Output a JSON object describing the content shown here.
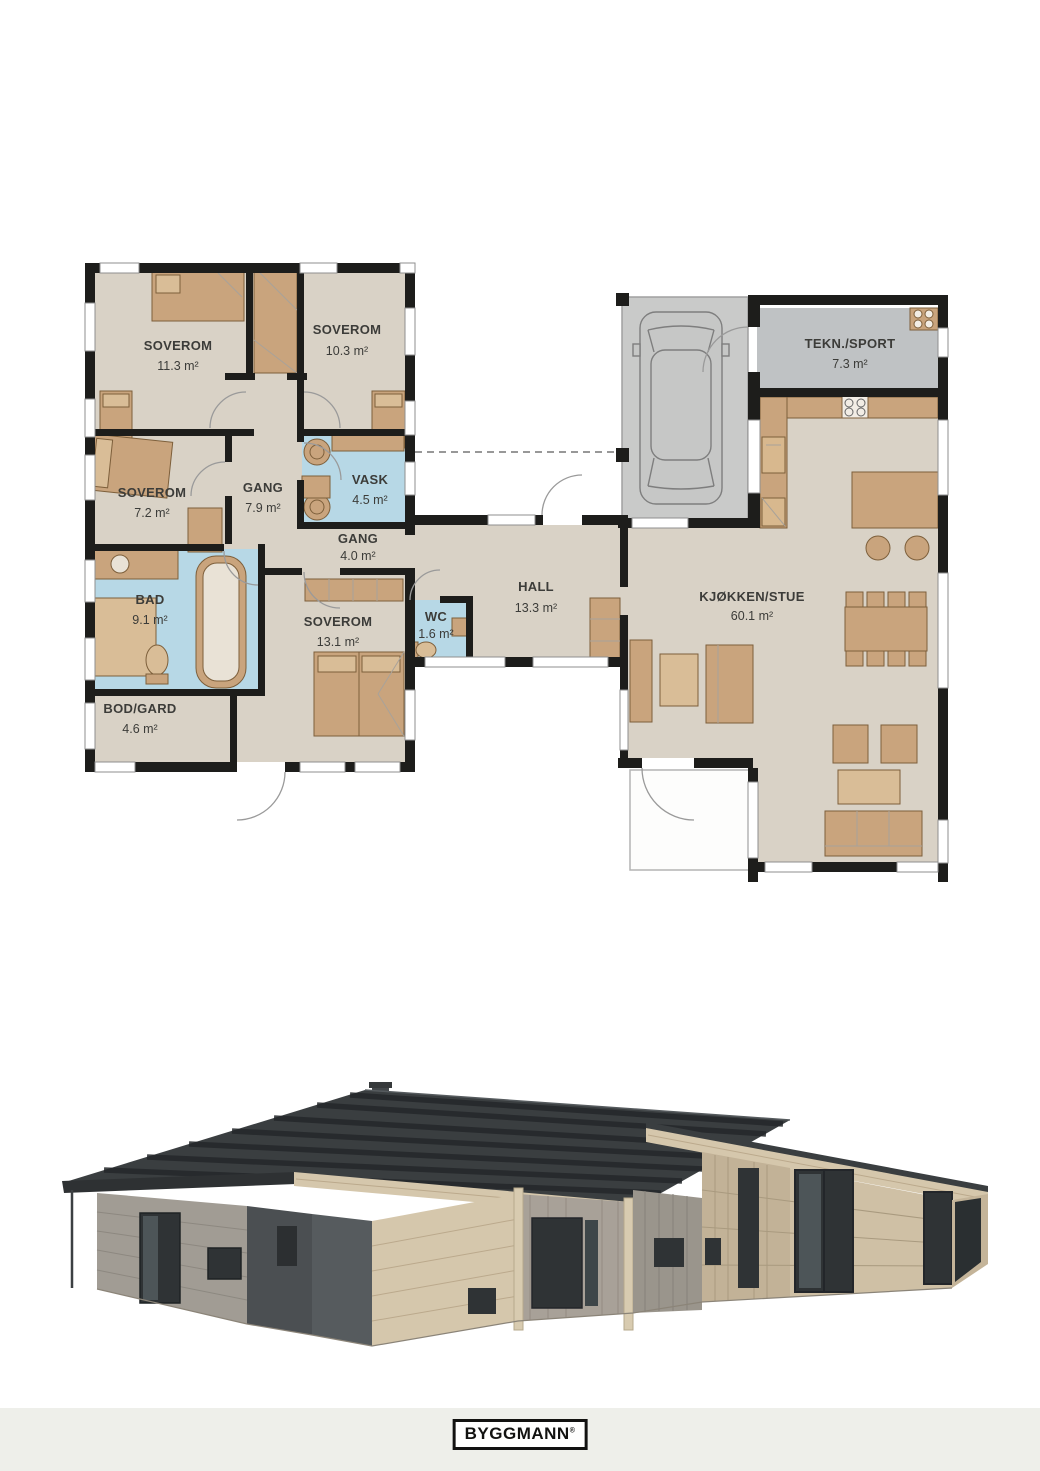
{
  "document": {
    "kind": "house floor plan brochure page"
  },
  "plan": {
    "rooms": [
      {
        "id": "soverom-11-3",
        "name": "SOVEROM",
        "area": "11.3 m²"
      },
      {
        "id": "soverom-10-3",
        "name": "SOVEROM",
        "area": "10.3 m²"
      },
      {
        "id": "soverom-7-2",
        "name": "SOVEROM",
        "area": "7.2 m²"
      },
      {
        "id": "gang-7-9",
        "name": "GANG",
        "area": "7.9 m²"
      },
      {
        "id": "vask",
        "name": "VASK",
        "area": "4.5 m²"
      },
      {
        "id": "gang-4-0",
        "name": "GANG",
        "area": "4.0 m²"
      },
      {
        "id": "bad",
        "name": "BAD",
        "area": "9.1 m²"
      },
      {
        "id": "bod-gard",
        "name": "BOD/GARD",
        "area": "4.6 m²"
      },
      {
        "id": "soverom-13-1",
        "name": "SOVEROM",
        "area": "13.1 m²"
      },
      {
        "id": "wc",
        "name": "WC",
        "area": "1.6 m²"
      },
      {
        "id": "hall",
        "name": "HALL",
        "area": "13.3 m²"
      },
      {
        "id": "tekn-sport",
        "name": "TEKN./SPORT",
        "area": "7.3 m²"
      },
      {
        "id": "kjokken-stue",
        "name": "KJØKKEN/STUE",
        "area": "60.1 m²"
      }
    ],
    "colors": {
      "wall": "#1d1d1b",
      "floor": "#d9d2c6",
      "wetroom": "#b7d8e6",
      "carport": "#c9cac9",
      "tech_room": "#bfc2c4",
      "furniture": "#c9a47d",
      "furniture_outline": "#7d5f3b"
    }
  },
  "render": {
    "colors": {
      "roof": "#3a3e40",
      "light_wood": "#d5c7ac",
      "gray_wood": "#a19c94",
      "dark_panel": "#4b4f52",
      "window": "#2f3335"
    }
  },
  "footer": {
    "logo": "BYGGMANN",
    "registered": "®"
  }
}
